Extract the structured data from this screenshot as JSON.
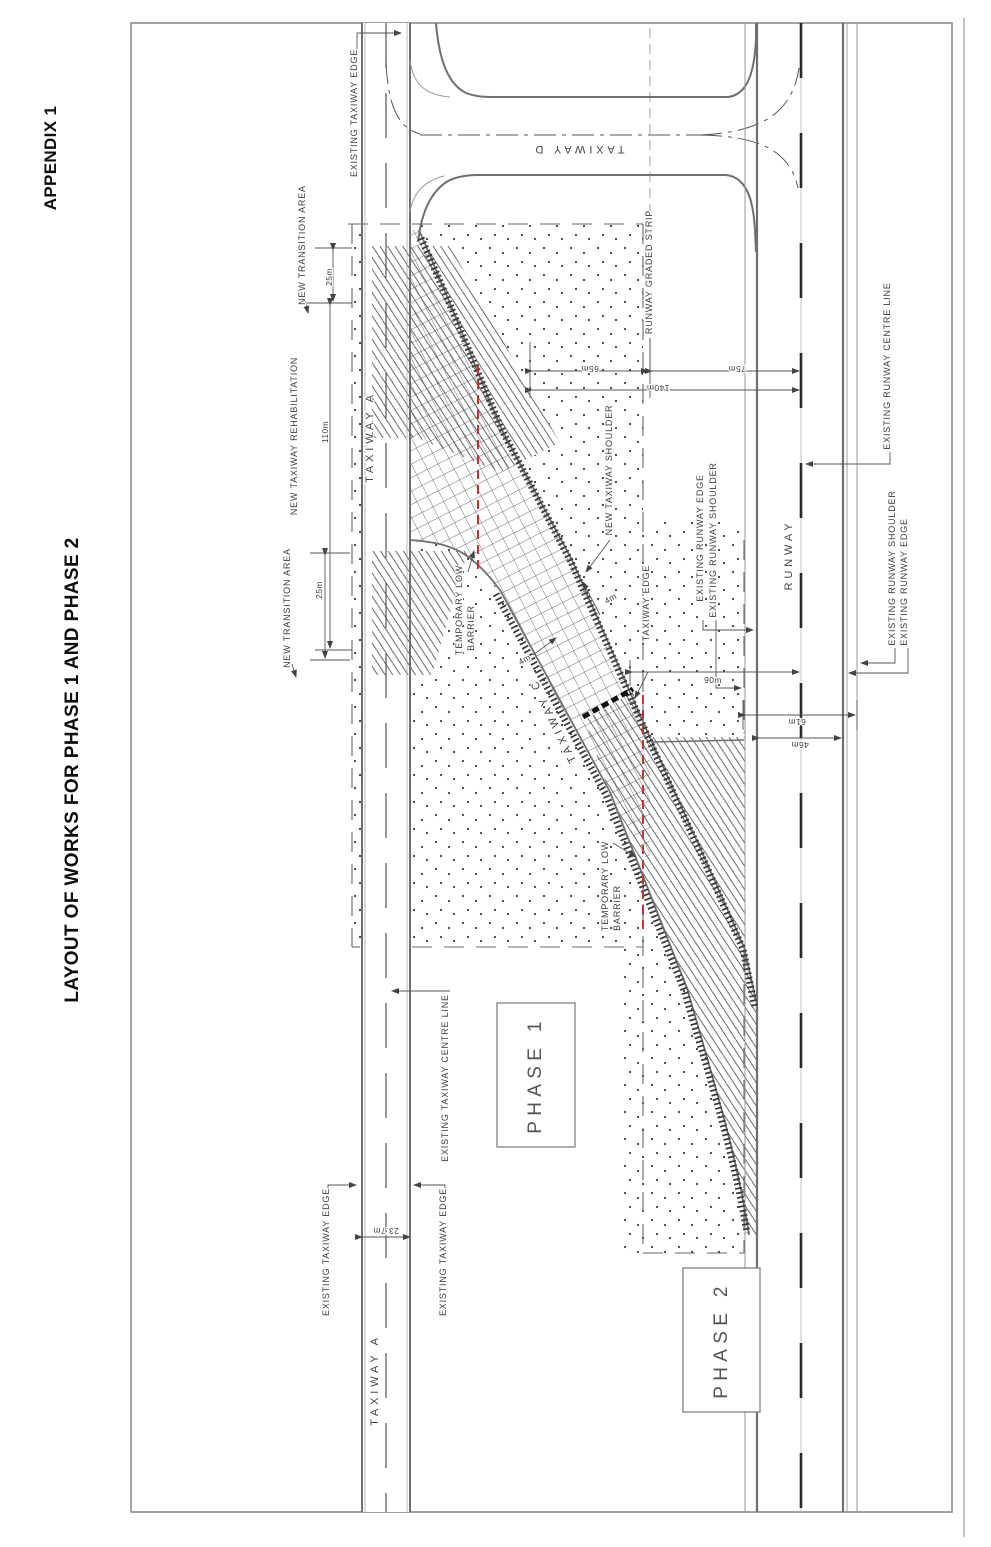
{
  "page": {
    "appendix": "APPENDIX 1",
    "title": "LAYOUT OF WORKS FOR PHASE 1 AND PHASE 2"
  },
  "colors": {
    "barrier_red": "#c23430",
    "line_grey": "#6f6f6f",
    "centreline_black": "#2a2a2a"
  },
  "drawing": {
    "taxiways": {
      "a_top": "TAXIWAY  A",
      "a_bottom": "TAXIWAY  A",
      "c": "TAXIWAY  C",
      "d": "TAXIWAY  D"
    },
    "runway": {
      "label": "RUNWAY",
      "graded_strip": "RUNWAY GRADED STRIP",
      "centre_line": "EXISTING RUNWAY CENTRE LINE",
      "shoulder": "EXISTING RUNWAY SHOULDER",
      "edge": "EXISTING RUNWAY EDGE"
    },
    "annotations": {
      "existing_taxiway_edge": "EXISTING TAXIWAY EDGE",
      "existing_taxiway_centre_line": "EXISTING TAXIWAY CENTRE LINE",
      "new_transition_area": "NEW TRANSITION AREA",
      "new_taxiway_rehabilitation": "NEW TAXIWAY REHABILITATION",
      "new_taxiway_shoulder": "NEW TAXIWAY SHOULDER",
      "taxiway_edge": "TAXIWAY EDGE",
      "temporary_low_barrier_line1": "TEMPORARY LOW",
      "temporary_low_barrier_line2": "BARRIER"
    },
    "phases": {
      "phase1": "PHASE 1",
      "phase2": "PHASE 2"
    },
    "dimensions": {
      "d25": "25m",
      "d110": "110m",
      "d65": "65m",
      "d75": "75m",
      "d140": "140m",
      "d90": "90m",
      "d61": "61m",
      "d46": "46m",
      "d4": "4m",
      "d23_7": "23.7m"
    }
  }
}
